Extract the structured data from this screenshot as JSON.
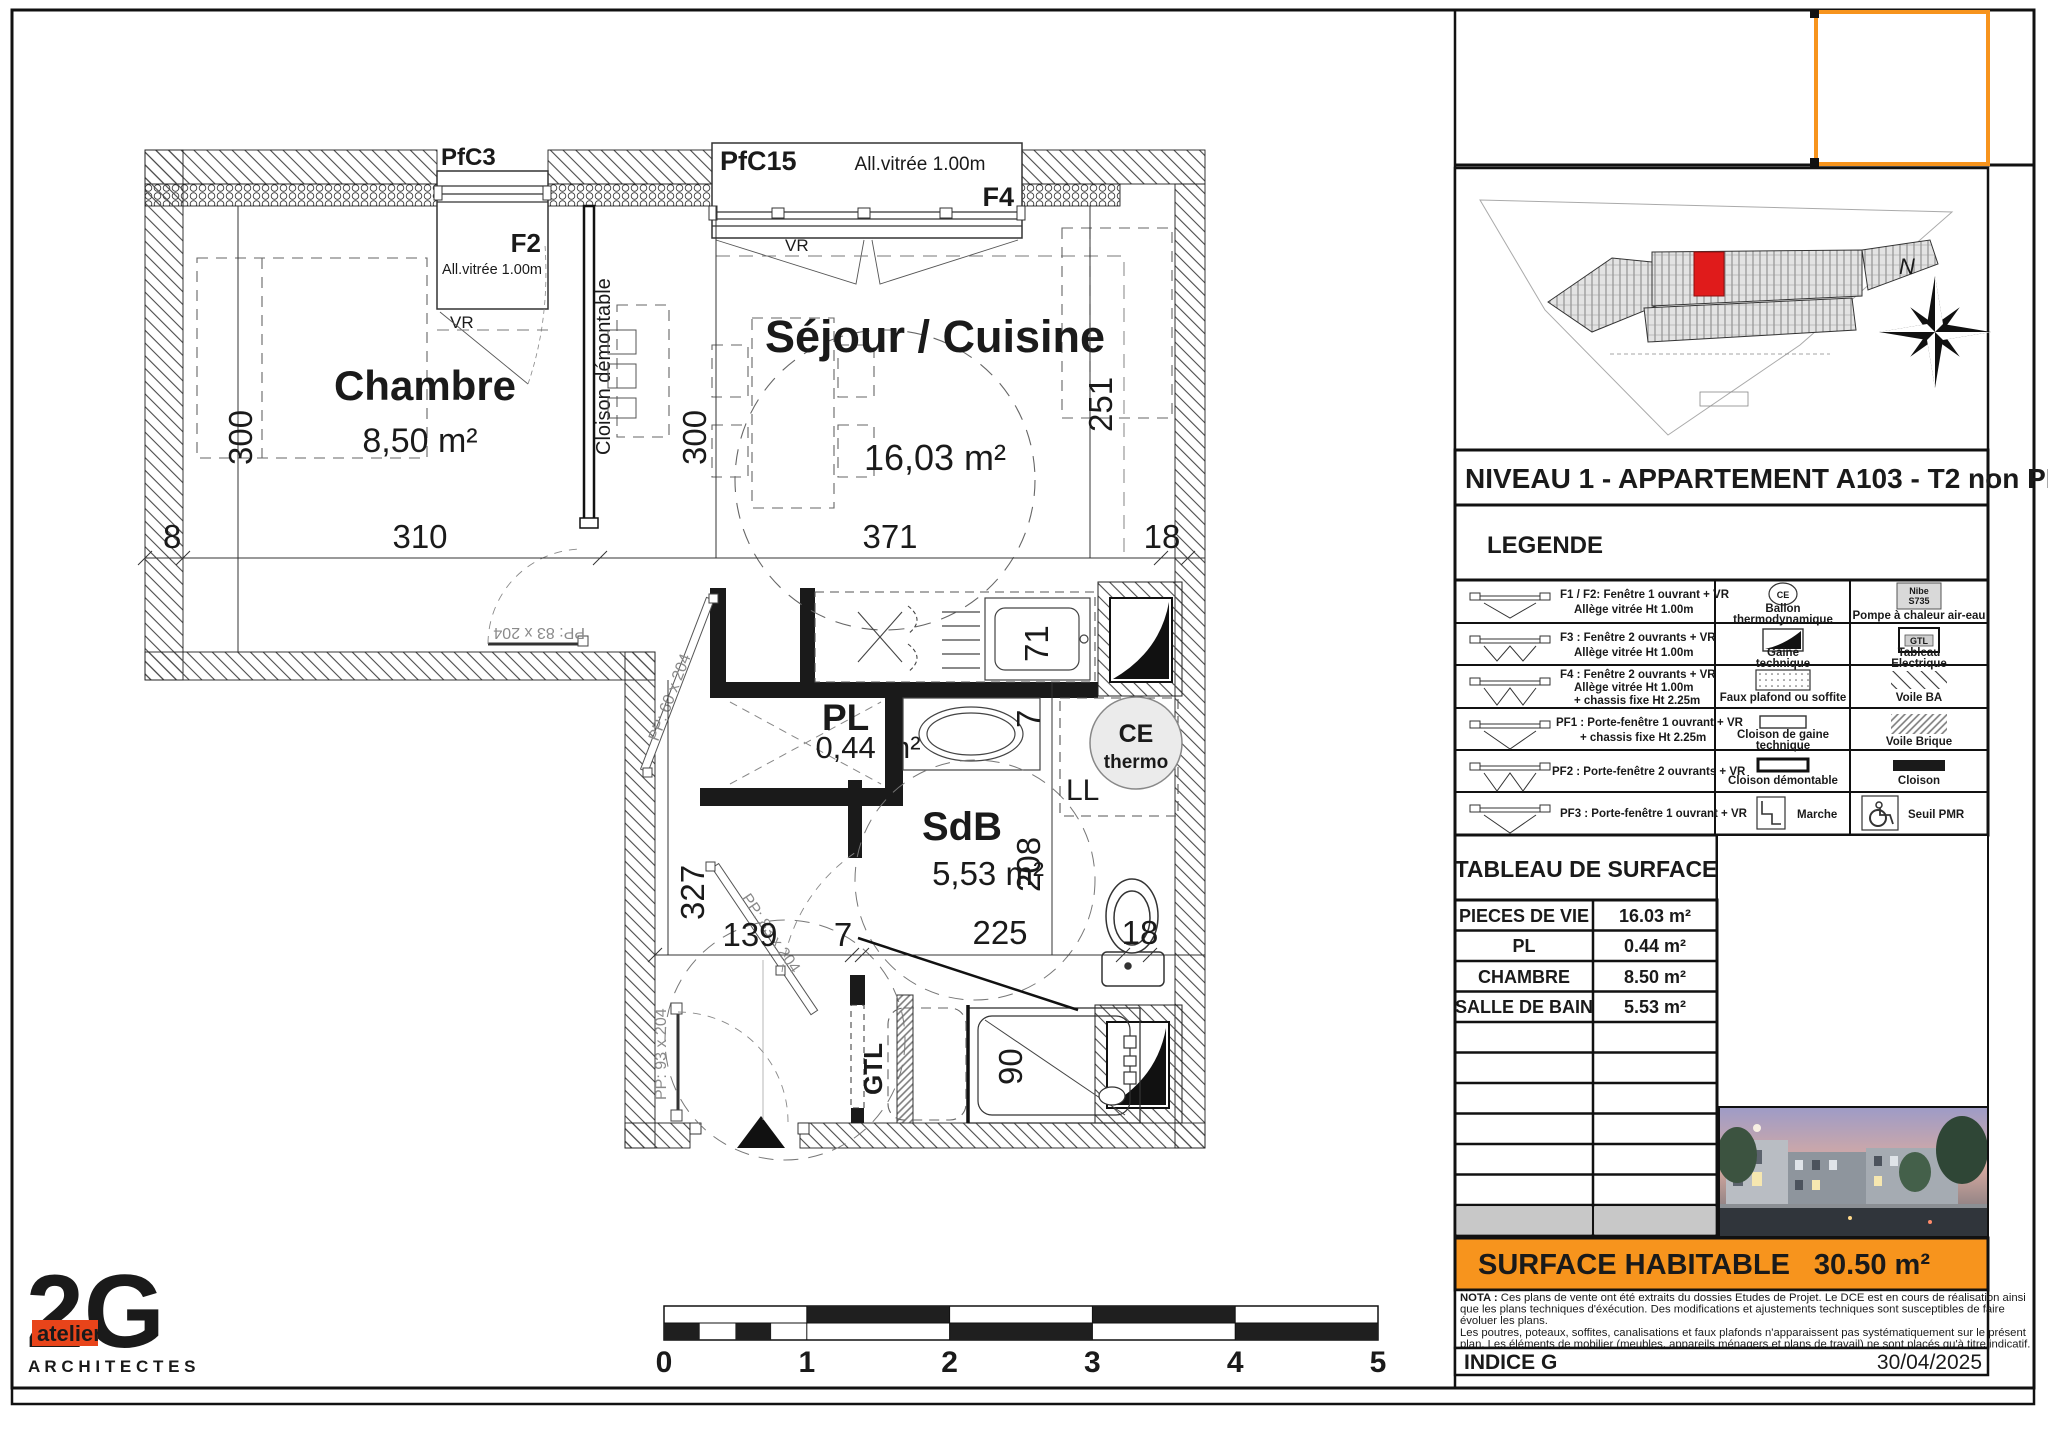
{
  "plan": {
    "windows": {
      "pfc3": {
        "name": "PfC3",
        "code": "F2",
        "allege": "All.vitrée 1.00m",
        "vr": "VR"
      },
      "pfc15": {
        "name": "PfC15",
        "code": "F4",
        "allege": "All.vitrée 1.00m",
        "vr": "VR"
      }
    },
    "rooms": {
      "chambre": {
        "name": "Chambre",
        "area": "8,50 m²"
      },
      "sejour": {
        "name": "Séjour / Cuisine",
        "area": "16,03 m²"
      },
      "pl": {
        "name": "PL",
        "area": "0,44 m²"
      },
      "sdb": {
        "name": "SdB",
        "area": "5,53 m²"
      }
    },
    "labels": {
      "cloison_demontable": "Cloison démontable",
      "ce": "CE",
      "thermo": "thermo",
      "ll": "LL",
      "gtl": "GTL"
    },
    "doors": {
      "entry": "PP: 93 x 204",
      "chambre": "PP: 83 x 204",
      "sdb": "PP: 83 x 204",
      "pl": "PP: 60 x 204"
    },
    "dims": {
      "top_8": "8",
      "top_310": "310",
      "top_371": "371",
      "top_18": "18",
      "left_300": "300",
      "sejour_300": "300",
      "right_251": "251",
      "hall_327": "327",
      "bottom_139": "139",
      "bottom_7": "7",
      "bottom_225": "225",
      "bottom_18": "18",
      "sink_71": "71",
      "wall_7": "7",
      "sdb_208": "208",
      "shower_90": "90"
    }
  },
  "panel": {
    "title": "NIVEAU 1 - APPARTEMENT A103 - T2 non PMR",
    "north": "N",
    "legend": {
      "heading": "LEGENDE",
      "rows": [
        {
          "lines": [
            "F1 / F2: Fenêtre 1 ouvrant + VR",
            "Allège vitrée Ht 1.00m"
          ],
          "mid": [
            "Ballon",
            "thermodynamique"
          ],
          "right": [
            "Pompe à chaleur air-eau"
          ]
        },
        {
          "lines": [
            "F3 : Fenêtre 2 ouvrants + VR",
            "Allège vitrée Ht 1.00m"
          ],
          "mid": [
            "Gaine",
            "technique"
          ],
          "right": [
            "Tableau",
            "Electrique"
          ]
        },
        {
          "lines": [
            "F4 : Fenêtre 2 ouvrants + VR",
            "Allège vitrée Ht 1.00m",
            "+ chassis fixe Ht 2.25m"
          ],
          "mid": [
            "Faux plafond ou soffite"
          ],
          "right": [
            "Voile BA"
          ]
        },
        {
          "lines": [
            "PF1 : Porte-fenêtre 1 ouvrant + VR",
            "+ chassis fixe Ht 2.25m"
          ],
          "mid": [
            "Cloison de gaine",
            "technique"
          ],
          "right": [
            "Voile Brique"
          ]
        },
        {
          "lines": [
            "PF2 : Porte-fenêtre 2 ouvrants + VR"
          ],
          "mid": [
            "Cloison démontable"
          ],
          "right": [
            "Cloison"
          ]
        },
        {
          "lines": [
            "PF3 : Porte-fenêtre 1 ouvrant + VR"
          ],
          "mid": [
            "Marche"
          ],
          "right": [
            "Seuil PMR"
          ]
        }
      ],
      "icon_texts": {
        "ce": "CE",
        "nibe1": "Nibe",
        "nibe2": "S735",
        "gtl": "GTL"
      }
    },
    "surface_table": {
      "heading": "TABLEAU DE SURFACE",
      "rows": [
        {
          "label": "PIECES DE VIE",
          "value": "16.03 m²"
        },
        {
          "label": "PL",
          "value": "0.44 m²"
        },
        {
          "label": "CHAMBRE",
          "value": "8.50 m²"
        },
        {
          "label": "SALLE DE BAIN",
          "value": "5.53 m²"
        }
      ]
    },
    "habitable": {
      "label": "SURFACE HABITABLE",
      "value": "30.50 m²"
    },
    "nota": {
      "bold": "NOTA :",
      "lines": [
        " Ces plans de vente ont été extraits du dossies Etudes de Projet. Le DCE est en cours de réalisation ainsi",
        "que les plans techniques d'éxécution. Des modifications et ajustements techniques sont susceptibles de faire",
        "évoluer les plans.",
        "Les poutres, poteaux, soffites, canalisations et faux plafonds n'apparaissent pas systématiquement sur le présent",
        "plan. Les éléments de mobilier (meubles, appareils ménagers et plans de travail) ne sont placés qu'à titre indicatif."
      ]
    },
    "indice": {
      "label": "INDICE G",
      "date": "30/04/2025"
    }
  },
  "logo": {
    "mark": "2G",
    "atelier": "atelier",
    "sub": "A R C H I T E C T E S"
  },
  "scalebar": {
    "labels": [
      "0",
      "1",
      "2",
      "3",
      "4",
      "5"
    ]
  },
  "colors": {
    "accent_orange": "#F7941D",
    "logo_orange": "#E8441A",
    "unit_red": "#E01B1B"
  }
}
